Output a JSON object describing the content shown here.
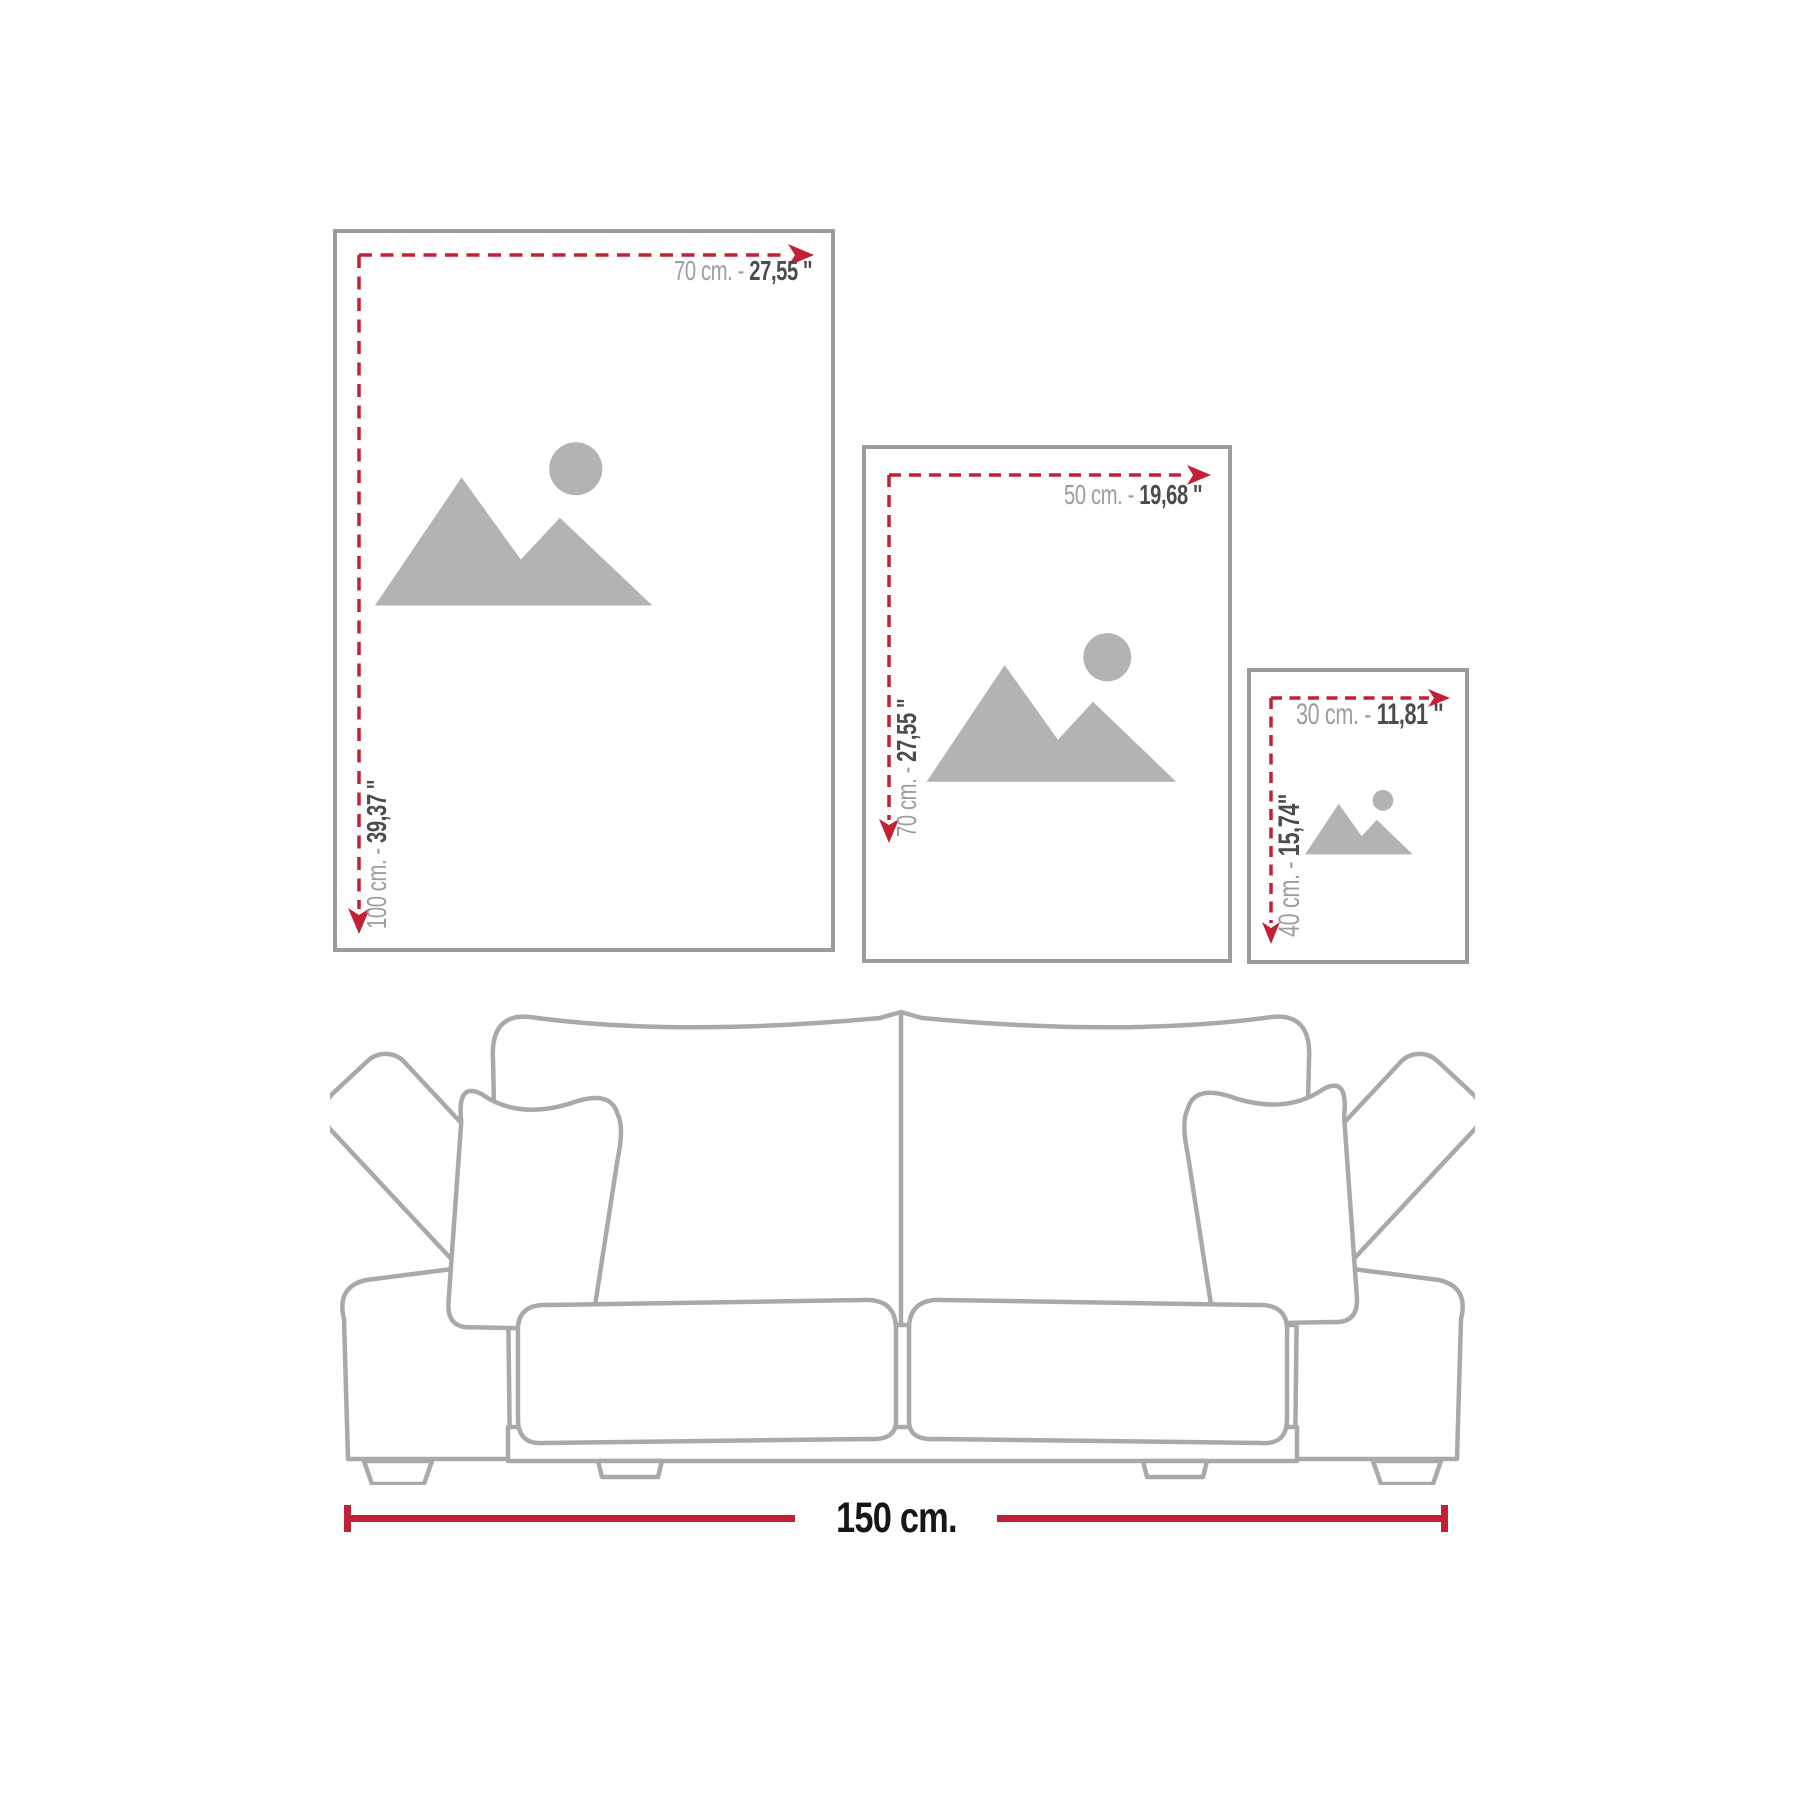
{
  "diagram_title": "poster-size-guide",
  "colors": {
    "accent_red": "#c22035",
    "frame_border_gray": "#9c9c9c",
    "label_gray": "#9b9da0",
    "label_dark": "#4b4c4e",
    "icon_gray": "#b3b3b3",
    "sofa_line_gray": "#a9a9a9",
    "measure_text_black": "#161616"
  },
  "frames": [
    {
      "name": "large",
      "width_value": "70 cm. - ",
      "width_inches": "27,55 ''",
      "height_value": "100 cm. - ",
      "height_inches": "39,37 ''"
    },
    {
      "name": "medium",
      "width_value": "50 cm. - ",
      "width_inches": "19,68 ''",
      "height_value": "70 cm. - ",
      "height_inches": "27,55 ''"
    },
    {
      "name": "small",
      "width_value": "30 cm. - ",
      "width_inches": "11,81 ''",
      "height_value": "40 cm. - ",
      "height_inches": "15,74''"
    }
  ],
  "sofa": {
    "width_label": "150 cm."
  }
}
